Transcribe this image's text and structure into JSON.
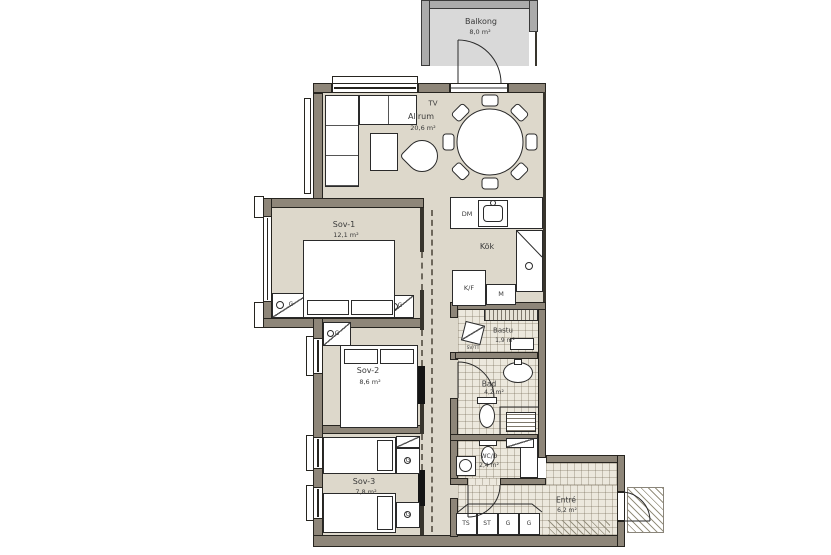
{
  "plan": {
    "title": "Apartment floor plan",
    "colors": {
      "floor": "#ddd8cb",
      "wall": "#8e8679",
      "balcony_floor": "#d9d9d9",
      "balcony_wall": "#ababab",
      "tile_floor": "#ece8dd",
      "outline": "#26241f",
      "text": "#3a3a3a"
    },
    "rooms": [
      {
        "name": "Balkong",
        "area": "8,0 m²"
      },
      {
        "name": "Allrum",
        "area": "20,6 m²"
      },
      {
        "name": "Sov-1",
        "area": "12,1 m²"
      },
      {
        "name": "Kök",
        "area": ""
      },
      {
        "name": "Sov-2",
        "area": "8,6 m²"
      },
      {
        "name": "Bastu",
        "area": "1,9 m²"
      },
      {
        "name": "Bad",
        "area": "4,2 m²"
      },
      {
        "name": "Sov-3",
        "area": "7,8 m²"
      },
      {
        "name": "WC/D",
        "area": "2,4 m²"
      },
      {
        "name": "Entré",
        "area": "6,2 m²"
      }
    ],
    "fixtures": {
      "tv": "TV",
      "dm": "DM",
      "kf": "K/F",
      "m": "M",
      "svtt": "SV/TT",
      "g": "G"
    },
    "cabinets": [
      "TS",
      "ST",
      "G",
      "G"
    ]
  }
}
